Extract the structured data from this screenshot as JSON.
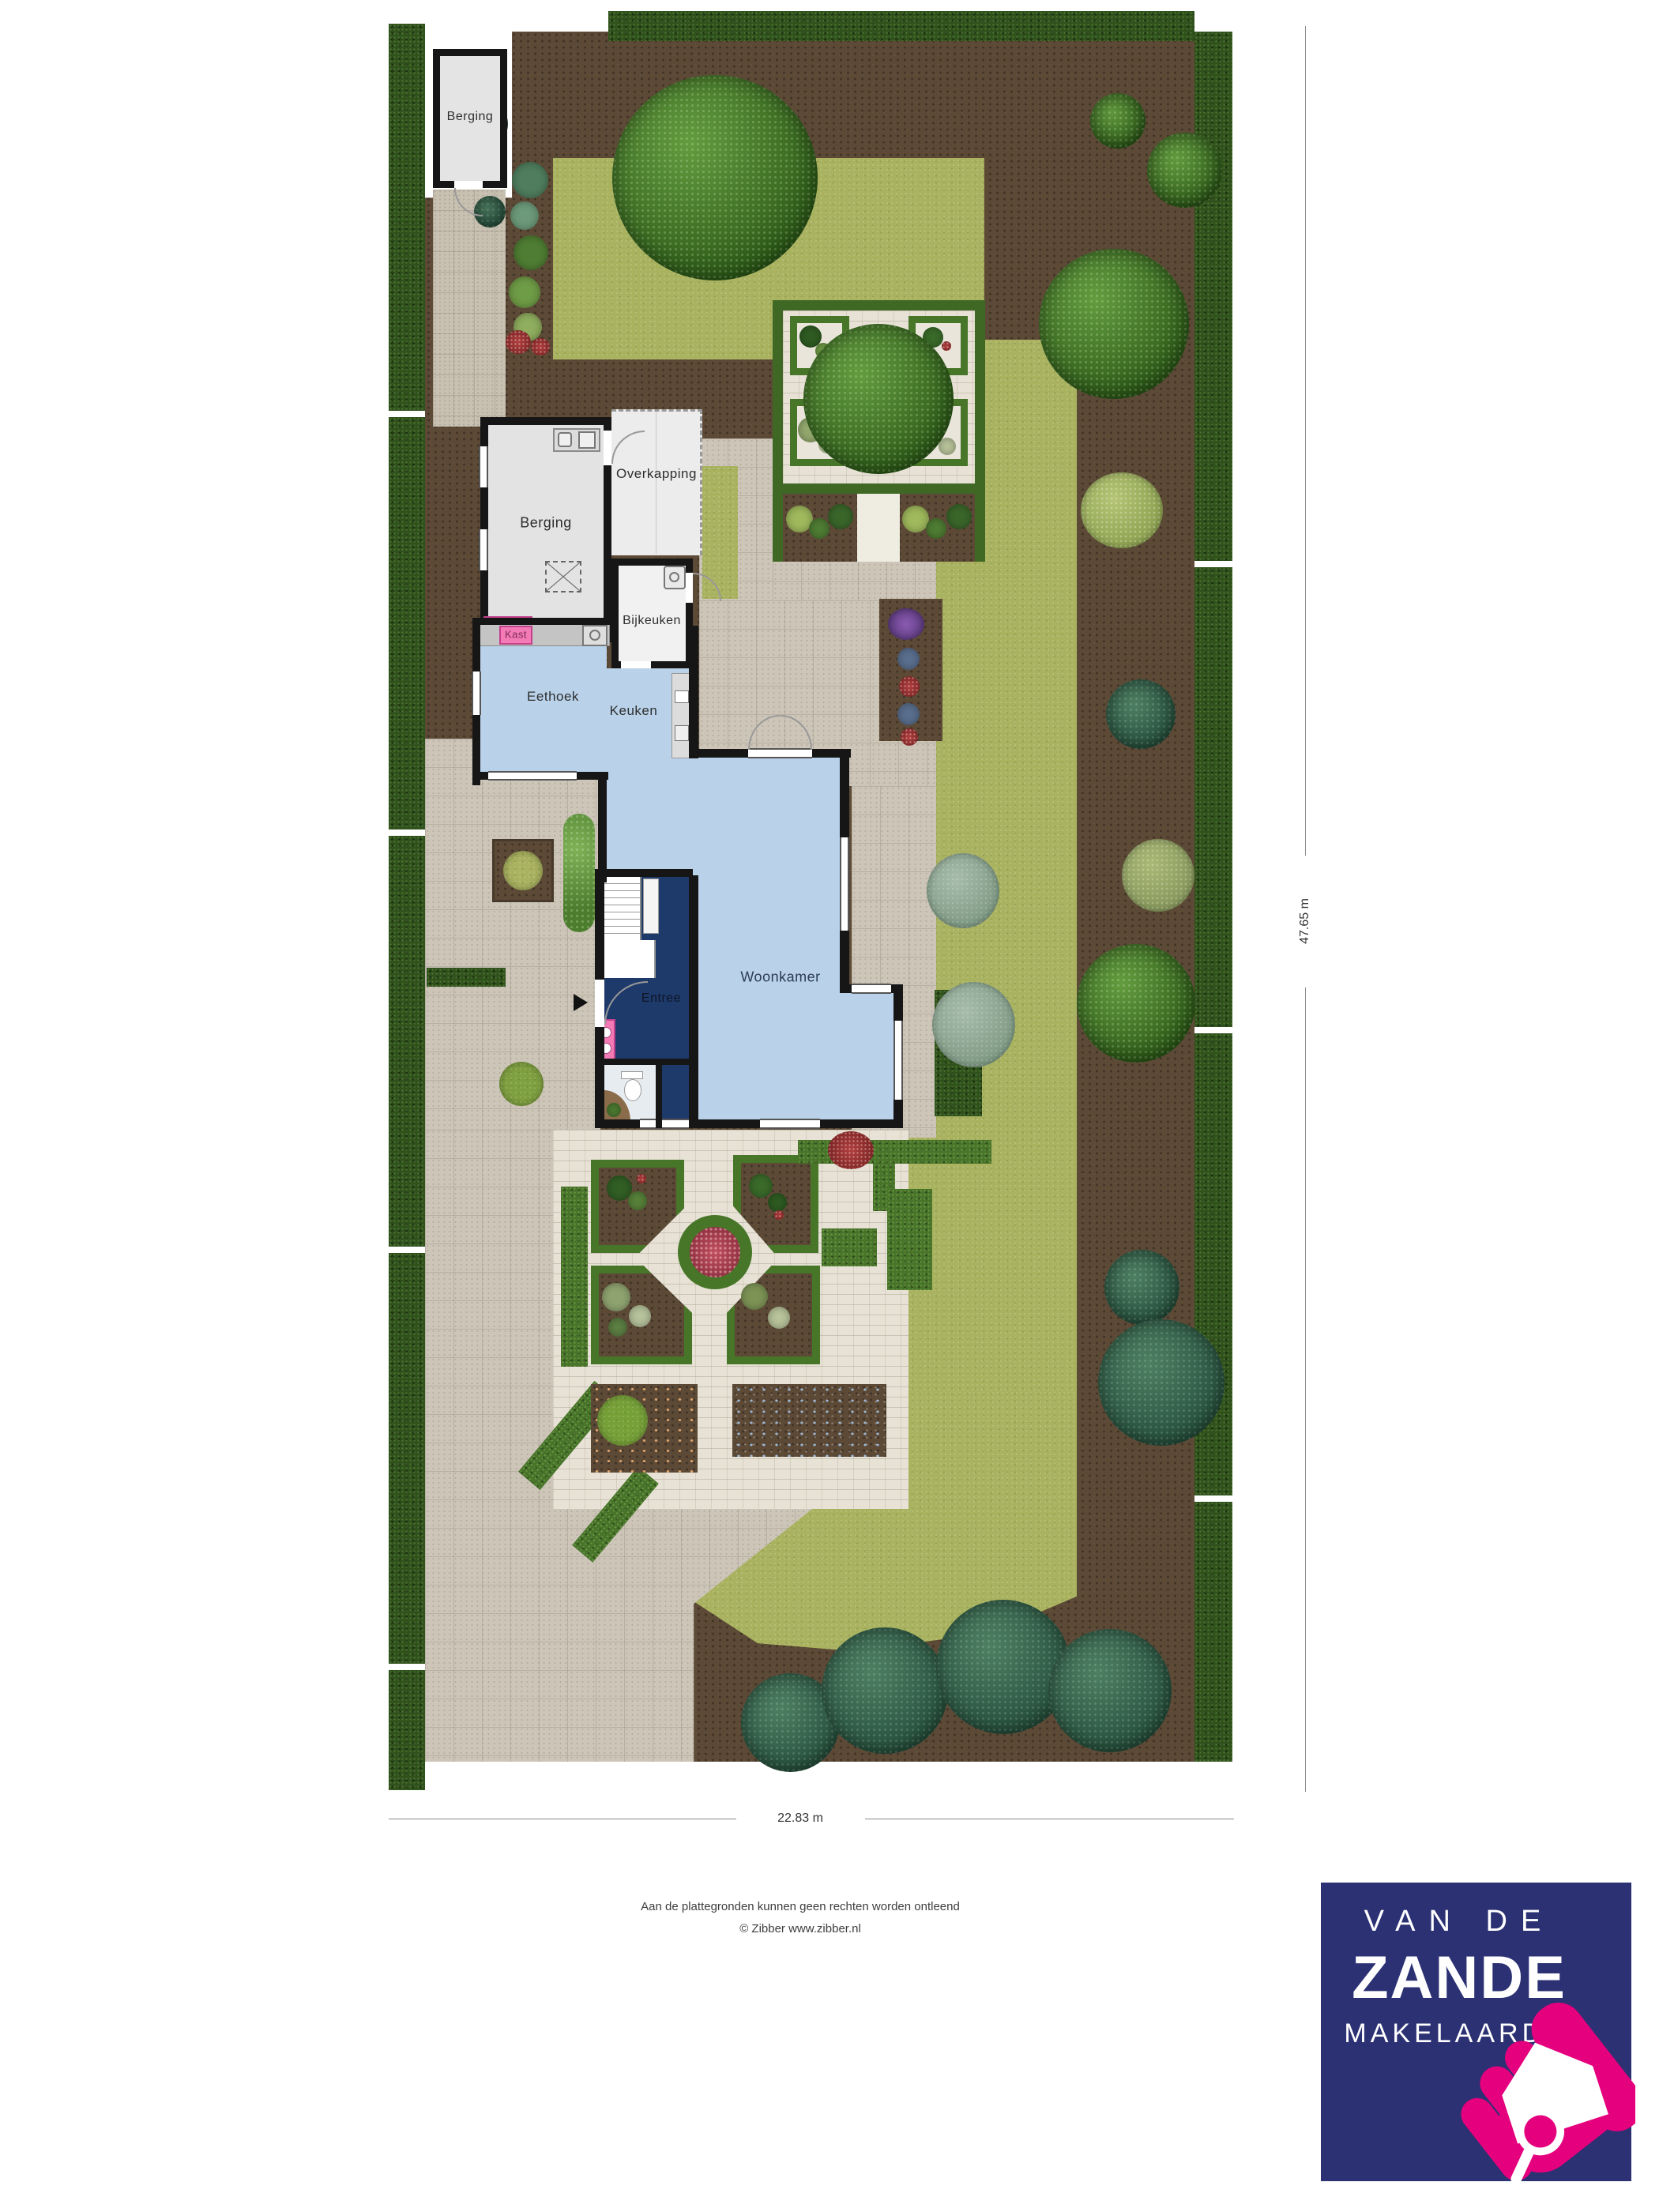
{
  "plan": {
    "rooms": {
      "shed": "Berging",
      "garage": "Berging",
      "overkapping": "Overkapping",
      "bijkeuken": "Bijkeuken",
      "kast": "Kast",
      "eethoek": "Eethoek",
      "keuken": "Keuken",
      "woonkamer": "Woonkamer",
      "entree": "Entree"
    },
    "dimensions": {
      "width": "22.83 m",
      "height": "47.65 m"
    },
    "footer": {
      "line1": "Aan de plattegronden kunnen geen rechten worden ontleend",
      "line2": "© Zibber www.zibber.nl"
    }
  },
  "logo": {
    "line1": "VAN DE",
    "line2": "ZANDE",
    "line3": "MAKELAARDIJ"
  },
  "colors": {
    "logo_navy": "#2b3173",
    "logo_pink": "#e5007d",
    "lawn": "#a9b25f",
    "soil": "#5c4936",
    "hedge": "#2f511c",
    "paving": "#ccc5b8",
    "floor_light": "#b9d2ea",
    "floor_navy": "#1e3a6b",
    "accent_pink": "#f37ab5"
  }
}
